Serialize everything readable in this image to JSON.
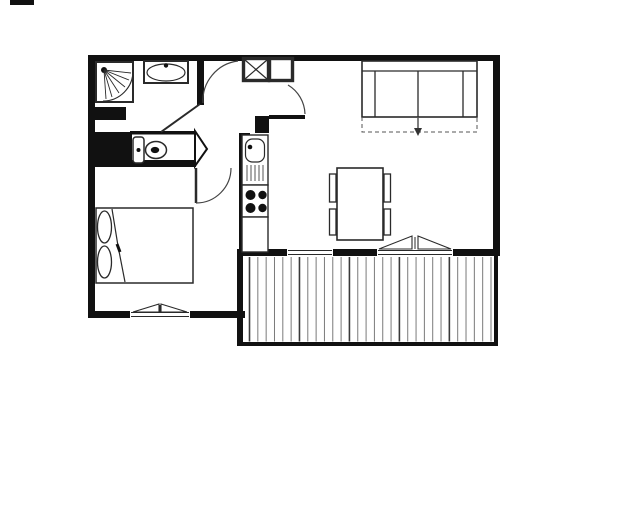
{
  "document": {
    "kind": "apartment-floor-plan-drawing",
    "visible_text": "",
    "orientation": "plan-view"
  },
  "colors": {
    "bg": "#ffffff",
    "wall": "#111111",
    "line": "#2a2a2a",
    "arc": "#444444",
    "deck": "#7a7a7a"
  },
  "rooms": [
    {
      "id": "bathroom",
      "fixtures": [
        "corner-shower",
        "washbasin",
        "swing-door"
      ]
    },
    {
      "id": "wc",
      "fixtures": [
        "toilet-with-cistern",
        "angled-wall"
      ]
    },
    {
      "id": "entrance-hall",
      "fixtures": [
        "closet-with-cross",
        "closet-plain",
        "door-swing-arcs"
      ]
    },
    {
      "id": "bedroom",
      "fixtures": [
        "double-bed",
        "two-pillows",
        "casement-window",
        "swing-door"
      ]
    },
    {
      "id": "kitchen",
      "fixtures": [
        "sink-with-drainer",
        "stove-four-burners",
        "counter-segment"
      ]
    },
    {
      "id": "living-room",
      "fixtures": [
        "sofa-bed-with-pullout-arrow",
        "dining-table",
        "four-chairs",
        "french-window",
        "window"
      ]
    },
    {
      "id": "balcony",
      "fixtures": [
        "wood-decking"
      ]
    }
  ],
  "balcony": {
    "plank_count": 30,
    "dark_every": 6
  },
  "stove": {
    "burner_count": 4
  },
  "chairs": {
    "count": 4
  },
  "symbols": {
    "dashed_rectangle_with_arrow": "sofa converts to bed (pull-out direction)",
    "double_triangle_on_wall": "casement window / french door",
    "quarter_circle_fan": "corner shower spray",
    "x_box": "built-in closet"
  }
}
